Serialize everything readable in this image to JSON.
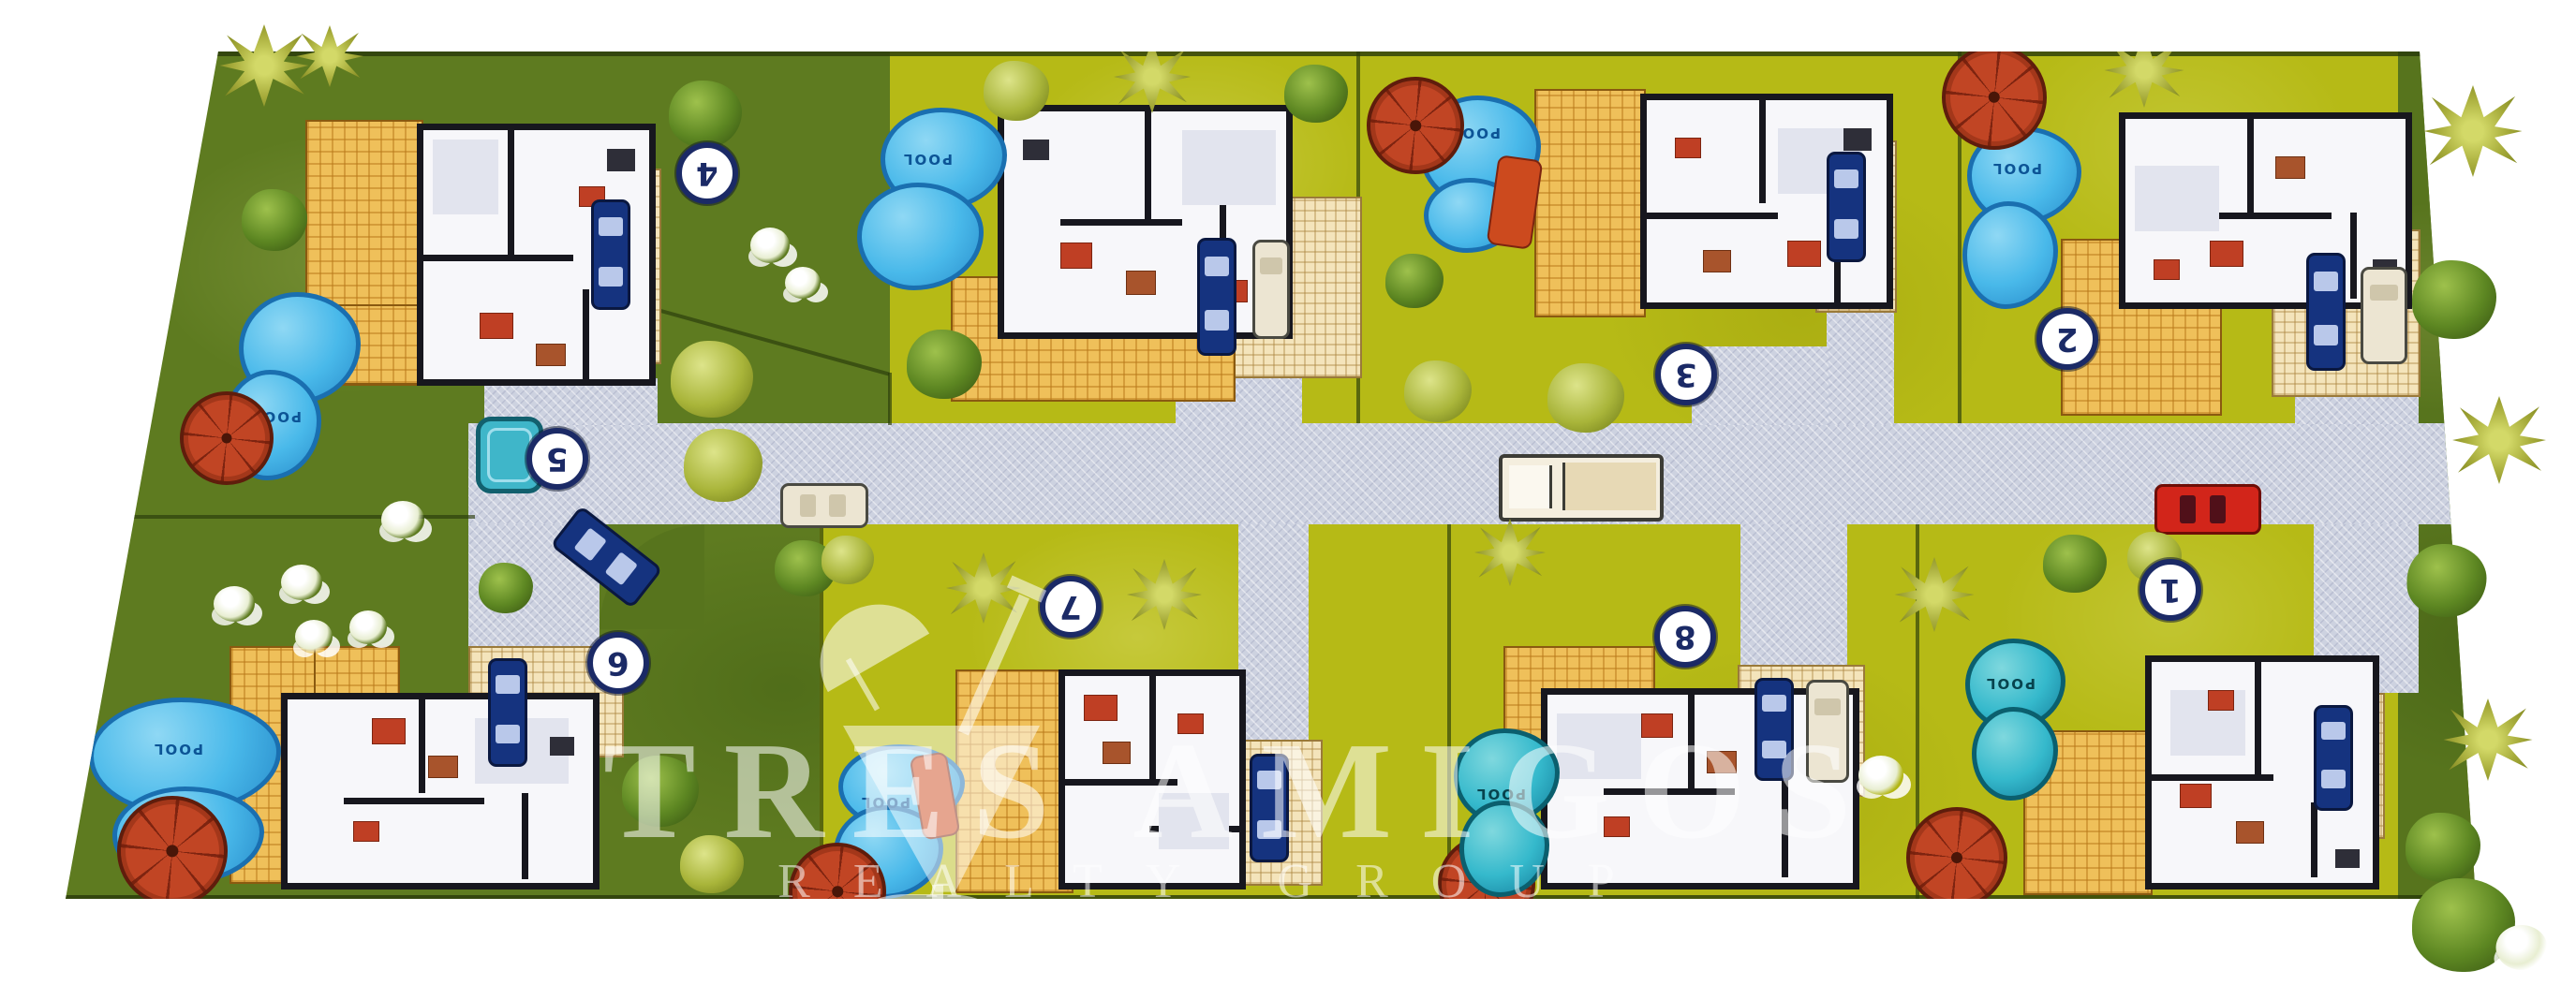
{
  "site": {
    "watermark": {
      "brand_line1": "TRES AMIGOS",
      "brand_line2": "REALTY GROUP"
    },
    "pool_label": "POOL",
    "lots": [
      {
        "number": "1"
      },
      {
        "number": "2"
      },
      {
        "number": "3"
      },
      {
        "number": "4"
      },
      {
        "number": "5"
      },
      {
        "number": "6"
      },
      {
        "number": "7"
      },
      {
        "number": "8"
      }
    ],
    "colors": {
      "lot_dark_green": "#5e7b20",
      "lot_yellow_green": "#b6ba16",
      "road_gray": "#cdd2e0",
      "pool_blue": "#49b9ea",
      "pool_teal": "#35b9cc",
      "umbrella_red": "#c14524",
      "deck_yellow": "#efc05a",
      "marker_navy": "#1b2a66",
      "watermark_white": "rgba(255,255,255,0.55)"
    }
  }
}
